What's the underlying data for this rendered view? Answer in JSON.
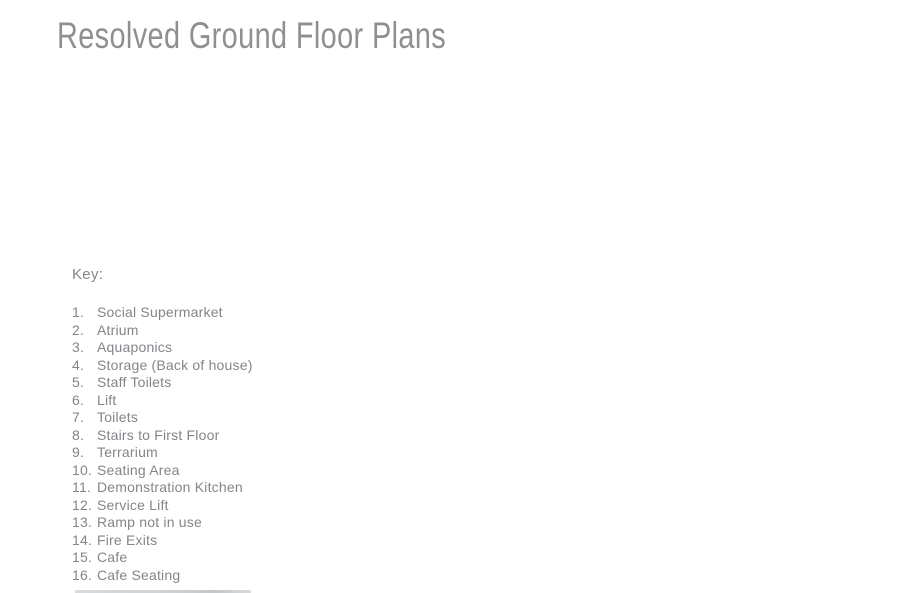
{
  "page_title": "Resolved Ground Floor Plans",
  "key": {
    "heading": "Key:",
    "items": [
      {
        "num": "1.",
        "label": "Social Supermarket"
      },
      {
        "num": "2.",
        "label": "Atrium"
      },
      {
        "num": "3.",
        "label": "Aquaponics"
      },
      {
        "num": "4.",
        "label": "Storage (Back of house)"
      },
      {
        "num": "5.",
        "label": "Staff Toilets"
      },
      {
        "num": "6.",
        "label": "Lift"
      },
      {
        "num": "7.",
        "label": "Toilets"
      },
      {
        "num": "8.",
        "label": "Stairs to First Floor"
      },
      {
        "num": "9.",
        "label": "Terrarium"
      },
      {
        "num": "10.",
        "label": "Seating Area"
      },
      {
        "num": "11.",
        "label": "Demonstration Kitchen"
      },
      {
        "num": "12.",
        "label": "Service Lift"
      },
      {
        "num": "13.",
        "label": "Ramp not in use"
      },
      {
        "num": "14.",
        "label": "Fire Exits"
      },
      {
        "num": "15.",
        "label": "Cafe"
      },
      {
        "num": "16.",
        "label": "Cafe Seating"
      }
    ]
  },
  "colors": {
    "background": "#ffffff",
    "title_text": "#8d9093",
    "body_text": "#82868a"
  }
}
